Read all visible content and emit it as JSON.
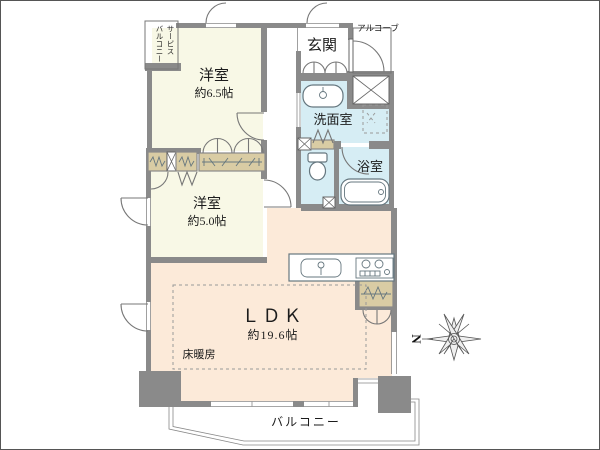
{
  "floorplan": {
    "labels": {
      "service_balcony": "サービス\nバルコニー",
      "bedroom1_name": "洋室",
      "bedroom1_size": "約6.5帖",
      "entrance": "玄関",
      "alcove": "アルコーブ",
      "washroom": "洗面室",
      "bathroom": "浴室",
      "bedroom2_name": "洋室",
      "bedroom2_size": "約5.0帖",
      "ldk_name": "ＬＤＫ",
      "ldk_size": "約19.6帖",
      "floor_heating": "床暖房",
      "balcony": "バルコニー",
      "compass_north": "N"
    },
    "colors": {
      "wall": "#8a8a8a",
      "bedroom_floor": "#f8f8e6",
      "ldk_floor": "#fcead9",
      "wet_area_floor": "#d6edf4",
      "closet": "#d9cca4"
    }
  }
}
